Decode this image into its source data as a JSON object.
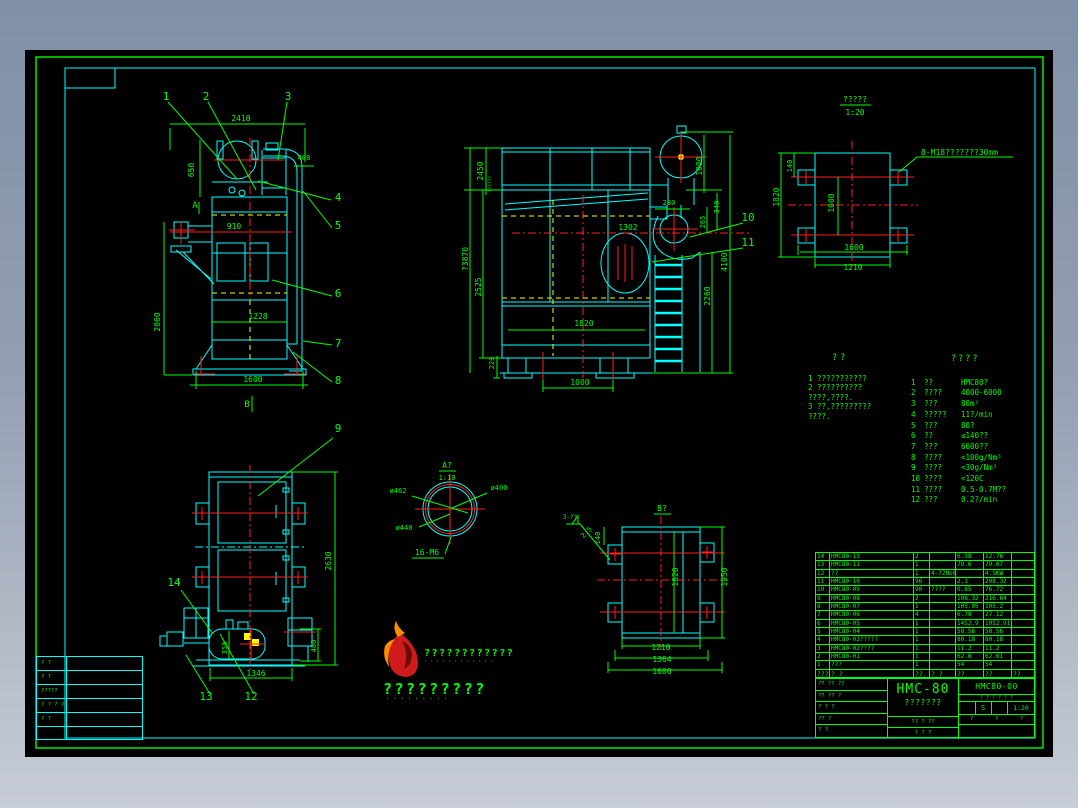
{
  "views": {
    "front": {
      "callouts": [
        "1",
        "2",
        "3",
        "4",
        "5",
        "6",
        "7",
        "8"
      ],
      "dims": {
        "top": "2410",
        "left_upper": "650",
        "duct": "408",
        "inlet": "910",
        "left_total": "2060",
        "inner": "1228",
        "base": "1600"
      },
      "labels": {
        "a": "A",
        "b": "B"
      }
    },
    "side": {
      "callouts": [
        "10",
        "11"
      ],
      "dims": {
        "left_top": "2450",
        "left_note": "??????",
        "total_h": "?3870",
        "left_mid": "2525",
        "left_base": "220",
        "base": "1000",
        "mid": "1302",
        "duct": "280",
        "inner": "1820",
        "right_top": "1000",
        "right_340": "340",
        "right_265": "265",
        "right_total": "4100",
        "ladder": "2260"
      }
    },
    "plan": {
      "title": "?????",
      "scale": "1:20",
      "bolt_note": "8-M18???????30mm",
      "dims": {
        "lug": "140",
        "depth": "1820",
        "inner": "1000",
        "outer_w": "1600",
        "inner_w": "1210"
      }
    },
    "rear": {
      "callouts": [
        "9",
        "12",
        "13",
        "14"
      ],
      "dims": {
        "height": "2630",
        "base": "1346",
        "stand": "480",
        "tank": "350"
      }
    },
    "detail_a": {
      "title": "A?",
      "scale": "1:10",
      "dia1": "ø462",
      "dia2": "ø400",
      "dia3": "ø440",
      "bolts": "16-M6"
    },
    "view_b": {
      "title": "B?",
      "weld": "3-??",
      "weld_size": "2.5",
      "dims": {
        "lug": "140",
        "depth": "1820",
        "height": "1950",
        "w1": "1210",
        "w2": "1364",
        "w3": "1600"
      }
    }
  },
  "notes": {
    "title": "??",
    "lines": [
      "1 ???????????",
      "2 ??????????",
      "  ????,????.",
      "3 ??,?????????",
      "  ????."
    ]
  },
  "params": {
    "title": "????",
    "rows": [
      {
        "no": "1",
        "label": "??",
        "value": "HMC80?"
      },
      {
        "no": "2",
        "label": "????",
        "value": "4000-6000"
      },
      {
        "no": "3",
        "label": "???",
        "value": "80m²"
      },
      {
        "no": "4",
        "label": "?????",
        "value": "11?/min"
      },
      {
        "no": "5",
        "label": "???",
        "value": "80?"
      },
      {
        "no": "6",
        "label": "??",
        "value": "≤140??"
      },
      {
        "no": "7",
        "label": "???",
        "value": "6000??"
      },
      {
        "no": "8",
        "label": "????",
        "value": "<100g/Nm³"
      },
      {
        "no": "9",
        "label": "????",
        "value": "<30g/Nm³"
      },
      {
        "no": "10",
        "label": "????",
        "value": "<120C"
      },
      {
        "no": "11",
        "label": "????",
        "value": "0.5-0.7M??"
      },
      {
        "no": "12",
        "label": "???",
        "value": "0.2?/min"
      }
    ]
  },
  "bom": {
    "rows": [
      [
        "14",
        "HMC80-13",
        "2",
        "",
        "6.38",
        "12.76",
        ""
      ],
      [
        "13",
        "HMC80-11",
        "1",
        "",
        "79.6",
        "79.67",
        ""
      ],
      [
        "12",
        "??",
        "1",
        "4-72No6C",
        "",
        "4.5KW",
        ""
      ],
      [
        "11",
        "HMC80-10",
        "96",
        "",
        "2.1",
        "208.32",
        ""
      ],
      [
        "10",
        "HMC80-09",
        "90",
        "????",
        "0.85",
        "76.72",
        ""
      ],
      [
        "9",
        "HMC80-08",
        "2",
        "",
        "108.32",
        "216.64",
        ""
      ],
      [
        "8",
        "HMC80-07",
        "1",
        "",
        "105.05",
        "105.2",
        ""
      ],
      [
        "7",
        "HMC80-06",
        "4",
        "",
        "6.78",
        "27.12",
        ""
      ],
      [
        "6",
        "HMC80-05",
        "1",
        "",
        "1452.9",
        "1952.91",
        ""
      ],
      [
        "5",
        "HMC80-04",
        "1",
        "",
        "58.56",
        "58.56",
        ""
      ],
      [
        "4",
        "HMC80-03?????",
        "1",
        "",
        "80.18",
        "80.18",
        ""
      ],
      [
        "3",
        "HMC80-02????",
        "1",
        "",
        "11.2",
        "11.2",
        ""
      ],
      [
        "2",
        "HMC80-01",
        "1",
        "",
        "62.6",
        "62.61",
        ""
      ],
      [
        "1",
        "???",
        "1",
        "",
        "54",
        "54",
        ""
      ]
    ],
    "footer": [
      "???",
      "? ?",
      "??",
      "? ?",
      "??",
      "??",
      "??"
    ]
  },
  "titleblock": {
    "model": "HMC-80",
    "subtitle": "???????",
    "drawing_no": "HMC80-00",
    "scale": "1:20",
    "sheet": "S",
    "left_rows": [
      "?? ?? ??",
      "?? ?? ?",
      "? ? ?",
      "?? ?",
      "? ?"
    ],
    "mid_rows": [
      "?? ? ??",
      "? ? ?"
    ],
    "right_marks": "? ? ? ? ? ?",
    "right_bottom": [
      "?",
      "?",
      "?"
    ]
  },
  "corner": {
    "rows": [
      "? ?",
      "? ?",
      "?????",
      "? ? ? ?",
      "? ?",
      ""
    ]
  },
  "logo": {
    "line1": "????????????",
    "line1_sub": "' ' ' ' ' ' ' ' ' ' ' '",
    "line2": "?????????",
    "line2_sub": "'  '  '  '  '  '  '  '  '"
  }
}
